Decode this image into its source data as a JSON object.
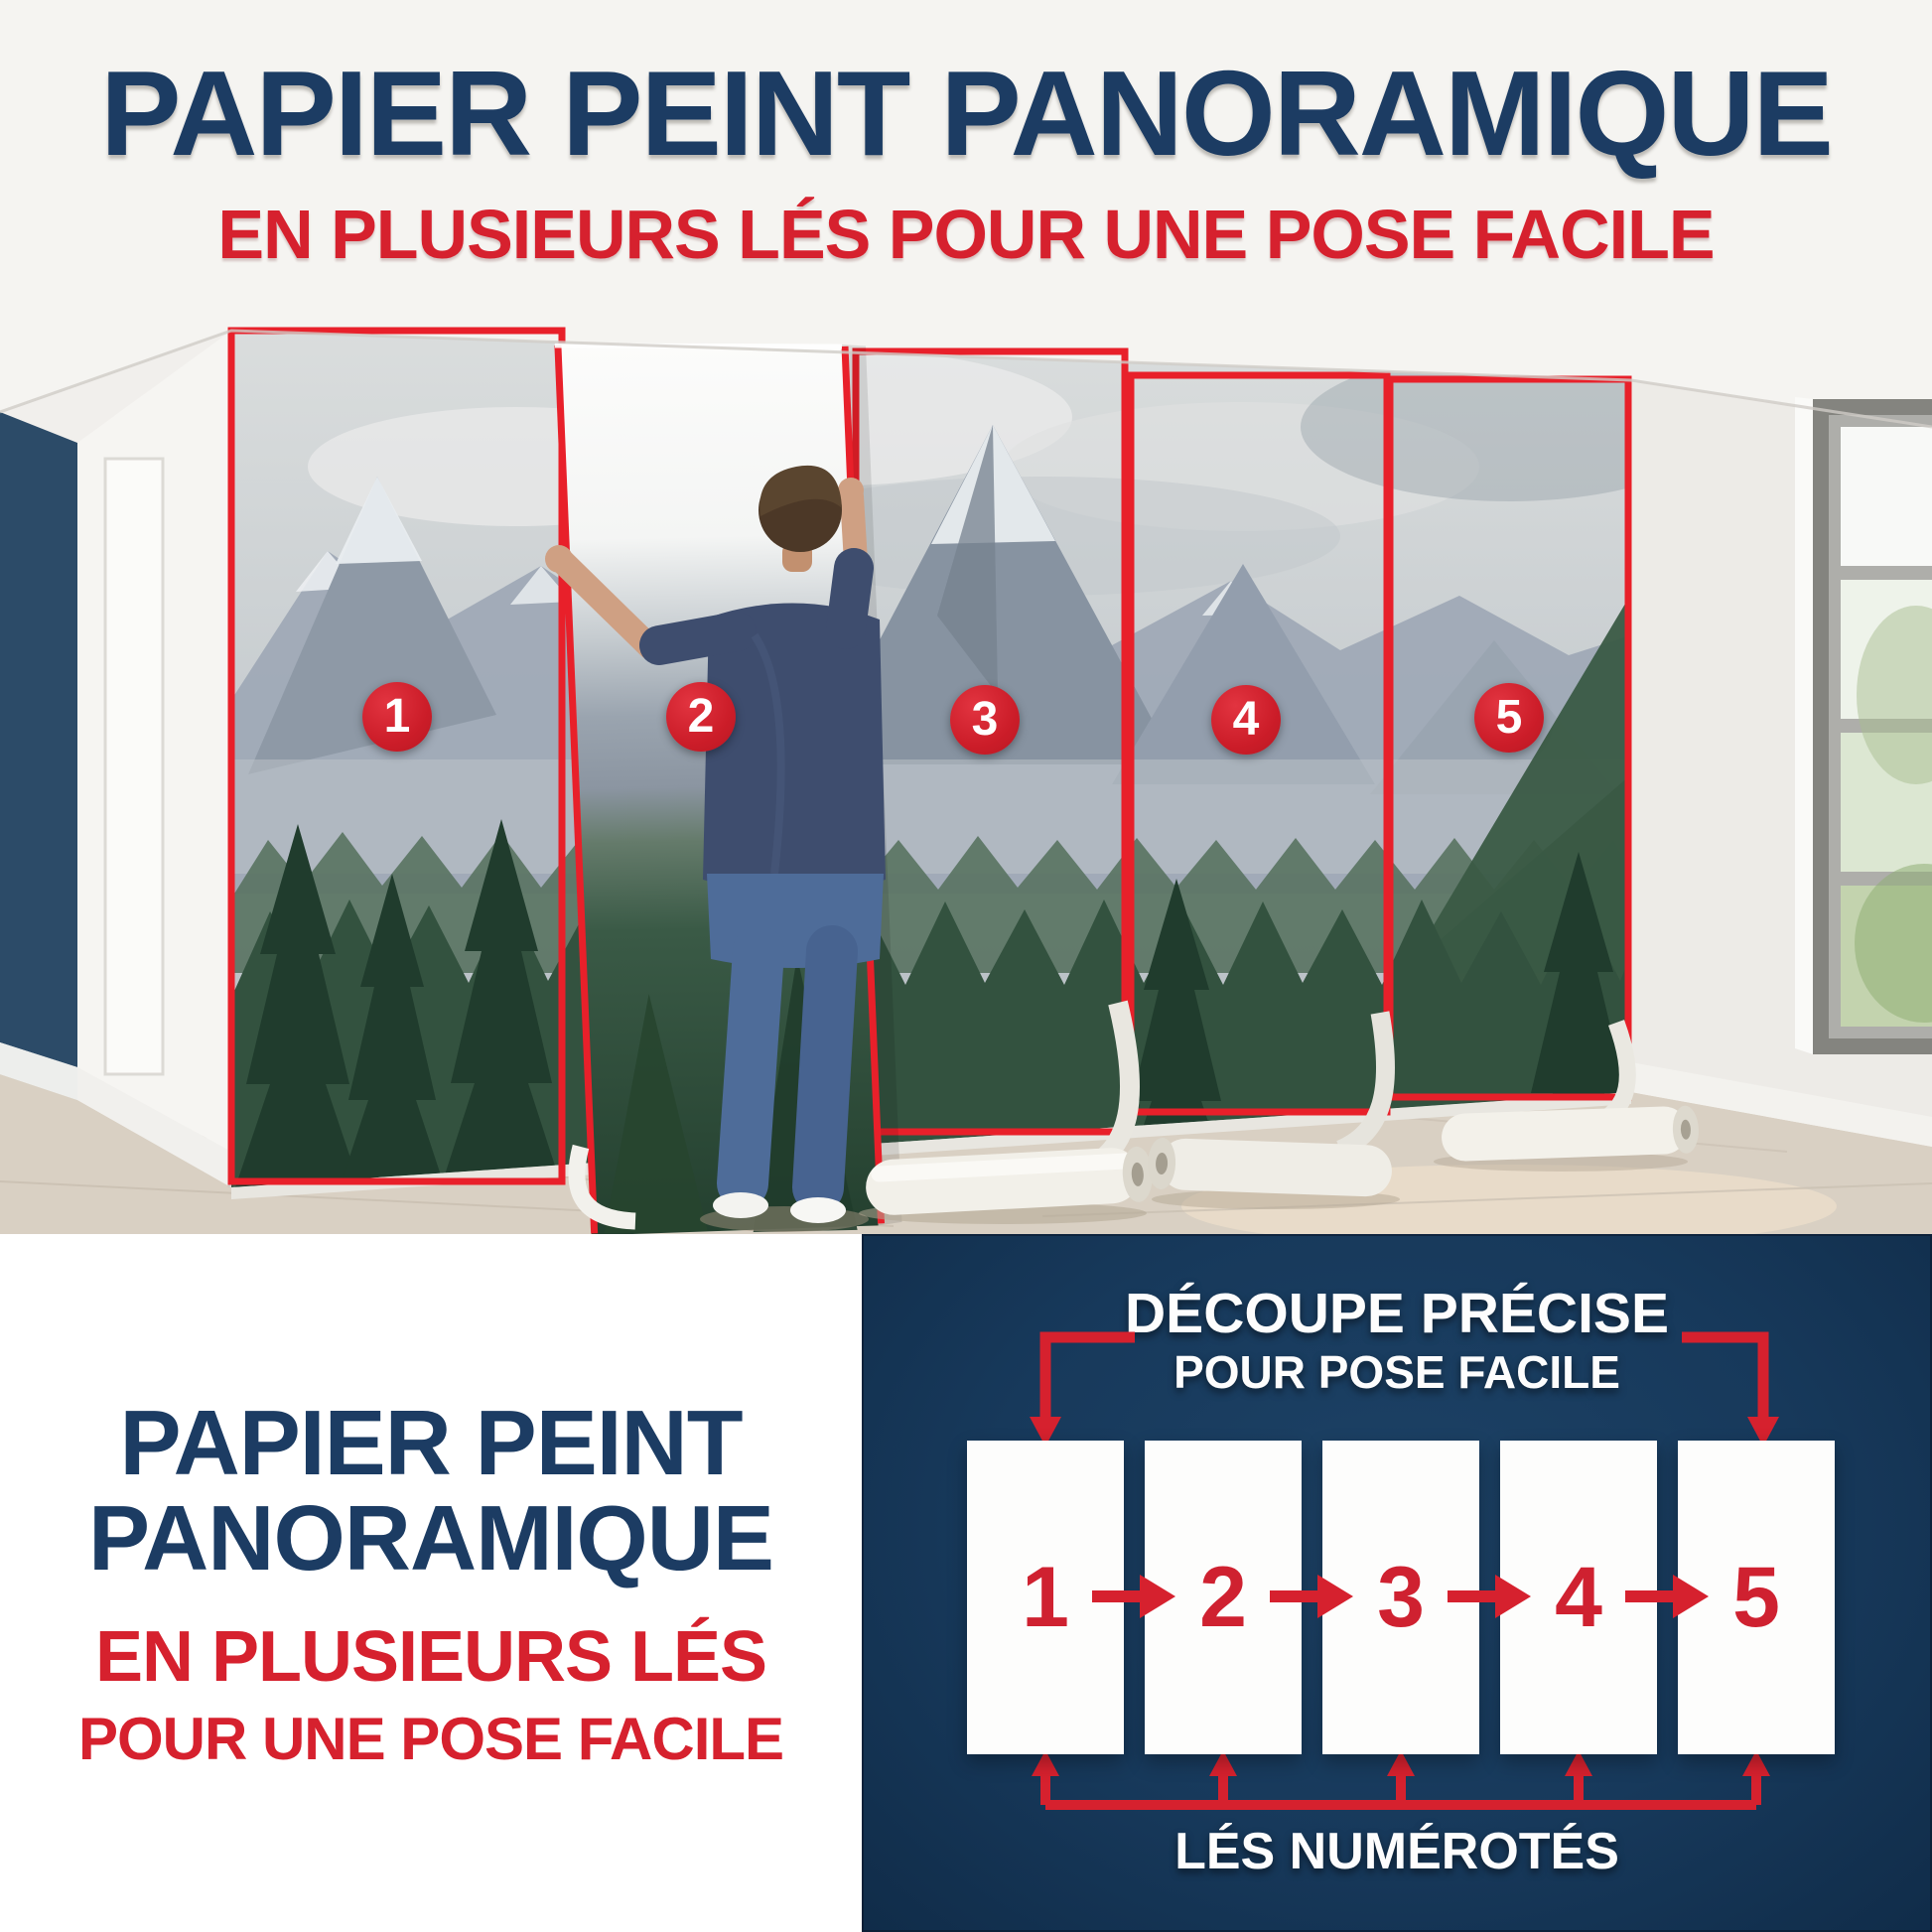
{
  "header": {
    "title": "PAPIER PEINT PANORAMIQUE",
    "subtitle": "EN PLUSIEURS LÉS POUR UNE POSE FACILE"
  },
  "photo": {
    "badge_numbers": [
      "1",
      "2",
      "3",
      "4",
      "5"
    ]
  },
  "bottom_left": {
    "title_line1": "PAPIER PEINT",
    "title_line2": "PANORAMIQUE",
    "subtitle_line1": "EN PLUSIEURS LÉS",
    "subtitle_line2": "POUR UNE POSE FACILE"
  },
  "diagram": {
    "heading_line1": "DÉCOUPE PRÉCISE",
    "heading_line2": "POUR POSE FACILE",
    "numbers": [
      "1",
      "2",
      "3",
      "4",
      "5"
    ],
    "caption": "LÉS NUMÉROTÉS"
  },
  "colors": {
    "navy_panel": "#17395b",
    "title_navy": "#1c3c63",
    "accent_red": "#d6212e",
    "panel_outline_red": "#e8202a"
  }
}
